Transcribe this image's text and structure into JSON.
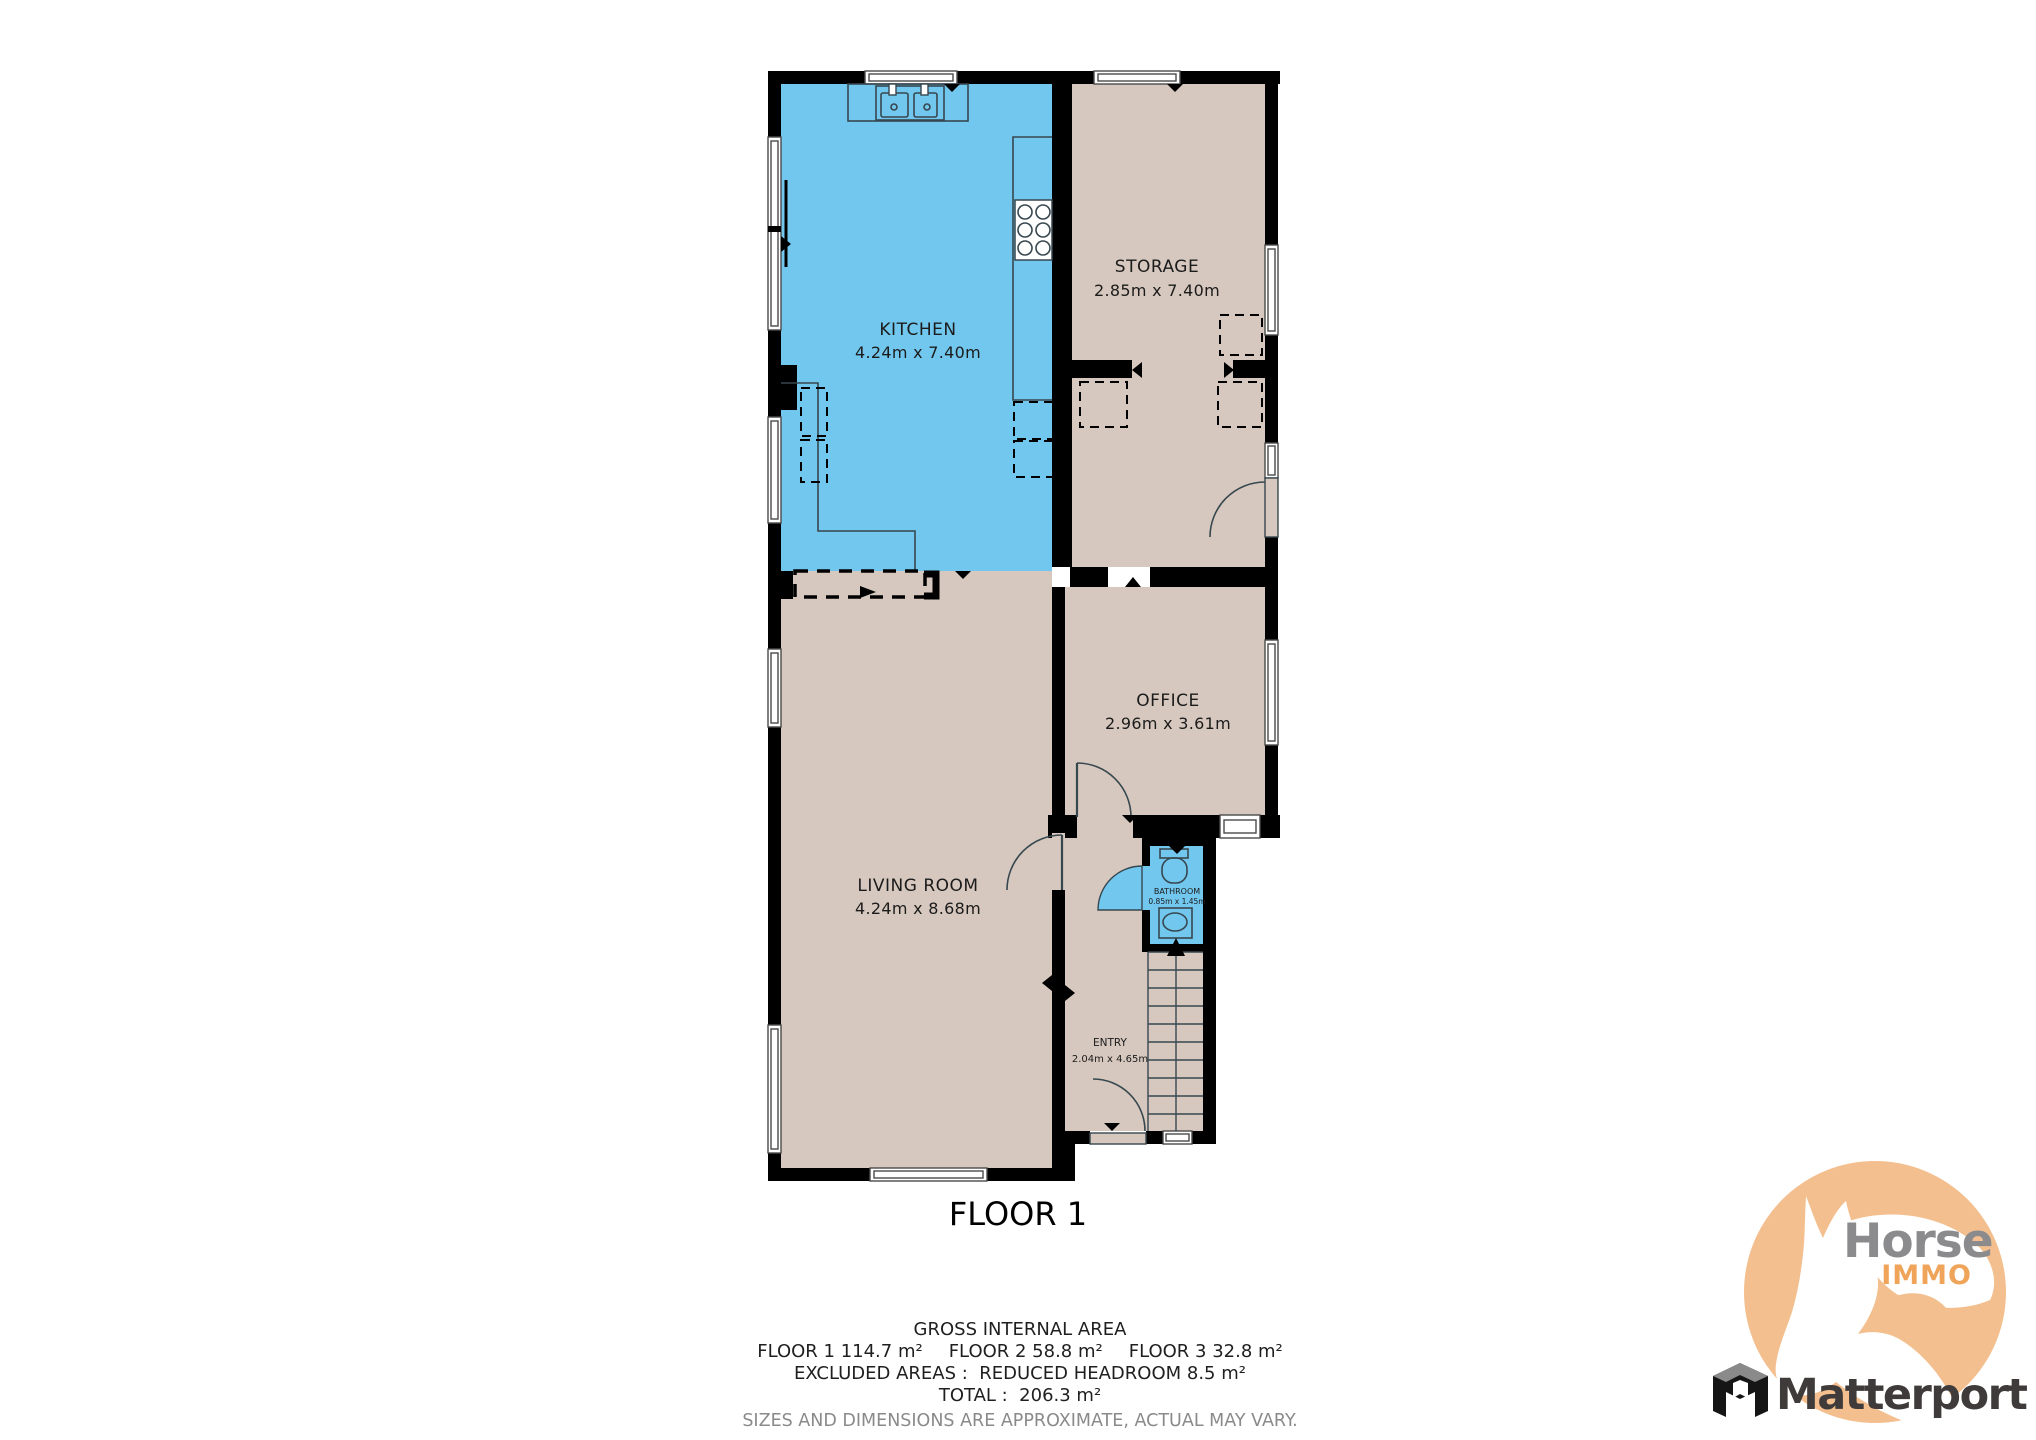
{
  "plan": {
    "title": "FLOOR 1",
    "rooms": [
      {
        "name": "KITCHEN",
        "dims": "4.24m x 7.40m"
      },
      {
        "name": "STORAGE",
        "dims": "2.85m x 7.40m"
      },
      {
        "name": "OFFICE",
        "dims": "2.96m x 3.61m"
      },
      {
        "name": "LIVING ROOM",
        "dims": "4.24m x 8.68m"
      },
      {
        "name": "BATHROOM",
        "dims": "0.85m x 1.45m"
      },
      {
        "name": "ENTRY",
        "dims": "2.04m x 4.65m"
      }
    ]
  },
  "footer": {
    "gross_title": "GROSS INTERNAL AREA",
    "floor1": "FLOOR 1 114.7 m²",
    "floor2": "FLOOR 2 58.8 m²",
    "floor3": "FLOOR 3 32.8 m²",
    "excluded": "EXCLUDED AREAS :  REDUCED HEADROOM 8.5 m²",
    "total": "TOTAL :  206.3 m²",
    "disclaimer": "SIZES AND DIMENSIONS ARE APPROXIMATE, ACTUAL MAY VARY."
  },
  "branding": {
    "horse": "Horse",
    "immo": "IMMO",
    "matterport": "Matterport"
  },
  "colors": {
    "highlight_room_fill": "#72c7ee",
    "room_fill": "#d6c8be",
    "wall": "#000000",
    "logo_circle": "#f4bf8e",
    "logo_horse_text": "#8b8b8d",
    "logo_immo_text": "#f0a459",
    "matterport_text": "#3f3b3a",
    "disclaimer_text": "#8a8a8a"
  }
}
